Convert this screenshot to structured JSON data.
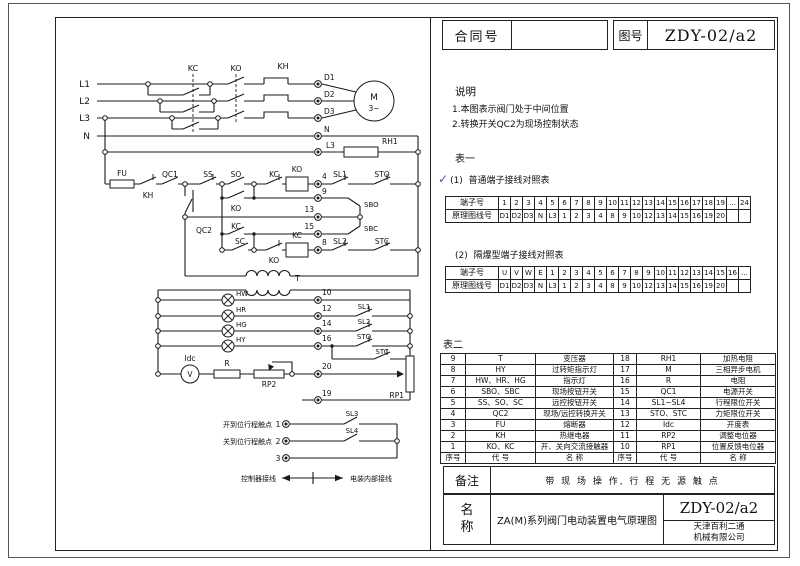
{
  "title_block": {
    "contract_label": "合同号",
    "contract_value": "",
    "drawing_label": "图号",
    "drawing_number": "ZDY-02/a2"
  },
  "notes": {
    "heading": "说明",
    "items": [
      "1.本图表示阀门处于中间位置",
      "2.转换开关QC2为现场控制状态"
    ]
  },
  "table_one": {
    "heading": "表一",
    "check": "✓",
    "sections": [
      {
        "label": "(1)",
        "title": "普通端子接线对照表",
        "row1_label": "端子号",
        "row2_label": "原理图线号",
        "terminals": [
          "1",
          "2",
          "3",
          "4",
          "5",
          "6",
          "7",
          "8",
          "9",
          "10",
          "11",
          "12",
          "13",
          "14",
          "15",
          "16",
          "17",
          "18",
          "19",
          "…",
          "24"
        ],
        "wires": [
          "D1",
          "D2",
          "D3",
          "N",
          "L3",
          "1",
          "2",
          "3",
          "4",
          "8",
          "9",
          "10",
          "12",
          "13",
          "14",
          "15",
          "16",
          "19",
          "20",
          "",
          ""
        ]
      },
      {
        "label": "(2)",
        "title": "隔爆型端子接线对照表",
        "row1_label": "端子号",
        "row2_label": "原理图线号",
        "terminals": [
          "U",
          "V",
          "W",
          "E",
          "1",
          "2",
          "3",
          "4",
          "5",
          "6",
          "7",
          "8",
          "9",
          "10",
          "11",
          "12",
          "13",
          "14",
          "15",
          "16",
          "…"
        ],
        "wires": [
          "D1",
          "D2",
          "D3",
          "N",
          "L3",
          "1",
          "2",
          "3",
          "4",
          "8",
          "9",
          "10",
          "12",
          "13",
          "14",
          "15",
          "16",
          "19",
          "20",
          "",
          ""
        ]
      }
    ]
  },
  "table_two": {
    "heading": "表二",
    "header": [
      "序号",
      "代 号",
      "名 称",
      "序号",
      "代 号",
      "名 称"
    ],
    "rows": [
      [
        "9",
        "T",
        "变压器",
        "18",
        "RH1",
        "加热电阻"
      ],
      [
        "8",
        "HY",
        "过转矩指示灯",
        "17",
        "M",
        "三相异步电机"
      ],
      [
        "7",
        "HW、HR、HG",
        "指示灯",
        "16",
        "R",
        "电阻"
      ],
      [
        "6",
        "SBO、SBC",
        "现场按钮开关",
        "15",
        "QC1",
        "电源开关"
      ],
      [
        "5",
        "SS、SO、SC",
        "远控按钮开关",
        "14",
        "SL1~SL4",
        "行程限位开关"
      ],
      [
        "4",
        "QC2",
        "现场/远控转换开关",
        "13",
        "STO、STC",
        "力矩限位开关"
      ],
      [
        "3",
        "FU",
        "熔断器",
        "12",
        "Idc",
        "开度表"
      ],
      [
        "2",
        "KH",
        "热继电器",
        "11",
        "RP2",
        "调整电位器"
      ],
      [
        "1",
        "KO、KC",
        "开、关向交流接触器",
        "10",
        "RP1",
        "位置反馈电位器"
      ]
    ]
  },
  "remark": {
    "label": "备注",
    "text": "带 现 场 操 作, 行 程 无 源 触 点"
  },
  "name_block": {
    "label_chars": [
      "名",
      "称"
    ],
    "name": "ZA(M)系列阀门电动装置电气原理图",
    "drawing_number": "ZDY-02/a2",
    "company": [
      "天津百利二通",
      "机械有限公司"
    ]
  },
  "colors": {
    "line": "#1a1a1a",
    "check": "#3a5fa8"
  },
  "circuit": {
    "labels": [
      [
        "l1",
        "L1",
        90,
        87,
        "e",
        9
      ],
      [
        "l2",
        "L2",
        90,
        104,
        "e",
        9
      ],
      [
        "l3",
        "L3",
        90,
        121,
        "e",
        9
      ],
      [
        "n-line",
        "N",
        90,
        139,
        "e",
        9
      ],
      [
        "kc-top",
        "KC",
        193,
        71,
        "m",
        8
      ],
      [
        "ko-top",
        "KO",
        236,
        71,
        "m",
        8
      ],
      [
        "kh-top",
        "KH",
        283,
        69,
        "m",
        8
      ],
      [
        "d1-terminal",
        "D1",
        324,
        80,
        "s",
        7.5
      ],
      [
        "d2-terminal",
        "D2",
        324,
        97,
        "s",
        7.5
      ],
      [
        "d3-terminal",
        "D3",
        324,
        114,
        "s",
        7.5
      ],
      [
        "n-terminal",
        "N",
        324,
        132,
        "s",
        7.5
      ],
      [
        "l3-terminal",
        "L3",
        326,
        148,
        "s",
        7.5
      ],
      [
        "rh1-heater",
        "RH1",
        382,
        144,
        "s",
        7.5
      ],
      [
        "motor-m",
        "M",
        374,
        100,
        "m",
        9
      ],
      [
        "motor-phase",
        "3~",
        374,
        111,
        "m",
        7.5
      ],
      [
        "fu-fuse",
        "FU",
        122,
        176,
        "m",
        7.5
      ],
      [
        "kh-contact",
        "KH",
        148,
        198,
        "m",
        7.5
      ],
      [
        "qc1-switch",
        "QC1",
        170,
        177,
        "m",
        7.5
      ],
      [
        "ss-button",
        "SS",
        208,
        177,
        "m",
        7.5
      ],
      [
        "so-button",
        "SO",
        236,
        177,
        "m",
        7.5
      ],
      [
        "kc-interlock",
        "KC",
        274,
        177,
        "m",
        7.5
      ],
      [
        "ko-coil",
        "KO",
        297,
        172,
        "m",
        7.5
      ],
      [
        "terminal-4",
        "4",
        322,
        179,
        "s",
        7.5
      ],
      [
        "sl1-limit",
        "SL1",
        340,
        177,
        "m",
        7.5
      ],
      [
        "sto-torque",
        "STO",
        382,
        177,
        "m",
        7.5
      ],
      [
        "ko-holding",
        "KO",
        236,
        211,
        "m",
        7.5
      ],
      [
        "terminal-9",
        "9",
        322,
        194,
        "s",
        7.5
      ],
      [
        "sbo-button",
        "SBO",
        364,
        207,
        "s",
        7
      ],
      [
        "qc2-selector",
        "QC2",
        196,
        233,
        "s",
        7.5
      ],
      [
        "terminal-13",
        "13",
        314,
        212,
        "e",
        7.5
      ],
      [
        "kc-holding",
        "KC",
        236,
        229,
        "m",
        7.5
      ],
      [
        "terminal-15",
        "15",
        314,
        229,
        "e",
        7.5
      ],
      [
        "sbc-button",
        "SBC",
        364,
        231,
        "s",
        7
      ],
      [
        "sc-button",
        "SC",
        240,
        244,
        "m",
        7.5
      ],
      [
        "ko-interlock",
        "KO",
        274,
        263,
        "m",
        7.5
      ],
      [
        "kc-coil",
        "KC",
        297,
        238,
        "m",
        7.5
      ],
      [
        "terminal-8",
        "8",
        322,
        245,
        "s",
        7.5
      ],
      [
        "sl2-limit",
        "SL2",
        340,
        244,
        "m",
        7.5
      ],
      [
        "stc-torque",
        "STC",
        382,
        244,
        "m",
        7.5
      ],
      [
        "transformer",
        "T",
        295,
        281,
        "s",
        8
      ],
      [
        "hw-lamp",
        "HW",
        236,
        296,
        "s",
        7
      ],
      [
        "hr-lamp",
        "HR",
        236,
        312,
        "s",
        7
      ],
      [
        "hg-lamp",
        "HG",
        236,
        327,
        "s",
        7
      ],
      [
        "hy-lamp",
        "HY",
        236,
        342,
        "s",
        7
      ],
      [
        "terminal-10",
        "10",
        322,
        295,
        "s",
        7.5
      ],
      [
        "terminal-12",
        "12",
        322,
        311,
        "s",
        7.5
      ],
      [
        "terminal-14",
        "14",
        322,
        326,
        "s",
        7.5
      ],
      [
        "terminal-16",
        "16",
        322,
        341,
        "s",
        7.5
      ],
      [
        "sl1-indication",
        "SL1",
        364,
        309,
        "m",
        7
      ],
      [
        "sl2-indication",
        "SL2",
        364,
        324,
        "m",
        7
      ],
      [
        "sto-indication",
        "STO",
        364,
        339,
        "m",
        7
      ],
      [
        "stc-indication",
        "STC",
        382,
        354,
        "m",
        7
      ],
      [
        "idc-meter",
        "Idc",
        190,
        361,
        "m",
        7.5
      ],
      [
        "idc-v",
        "V",
        190,
        377,
        "m",
        7.5
      ],
      [
        "r-resistor",
        "R",
        227,
        366,
        "m",
        7.5
      ],
      [
        "rp2-pot",
        "RP2",
        269,
        387,
        "m",
        7.5
      ],
      [
        "terminal-20",
        "20",
        322,
        369,
        "s",
        7.5
      ],
      [
        "rp1-pot",
        "RP1",
        404,
        398,
        "e",
        7.5
      ],
      [
        "terminal-19",
        "19",
        322,
        396,
        "s",
        7.5
      ],
      [
        "caption-open-position",
        "开到位行程触点",
        272,
        427,
        "e",
        7
      ],
      [
        "terminal-1",
        "1",
        278,
        427,
        "m",
        7.5
      ],
      [
        "sl3-contact",
        "SL3",
        352,
        416,
        "m",
        7
      ],
      [
        "caption-close-position",
        "关到位行程触点",
        272,
        444,
        "e",
        7
      ],
      [
        "terminal-2",
        "2",
        278,
        444,
        "m",
        7.5
      ],
      [
        "sl4-contact",
        "SL4",
        352,
        433,
        "m",
        7
      ],
      [
        "terminal-3",
        "3",
        278,
        461,
        "m",
        7.5
      ],
      [
        "caption-controller-wiring",
        "控制器接线",
        276,
        481,
        "e",
        7
      ],
      [
        "caption-internal-wiring",
        "电装内部接线",
        350,
        481,
        "s",
        7
      ]
    ]
  }
}
